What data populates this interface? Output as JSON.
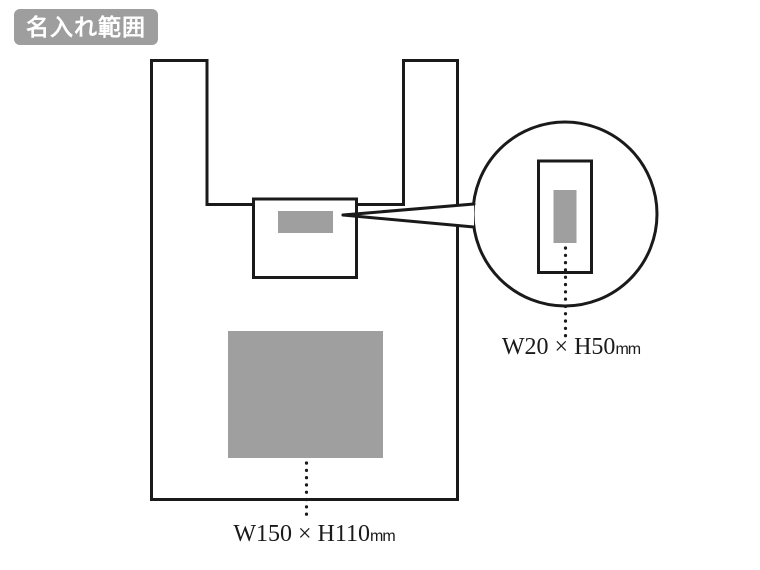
{
  "title_badge": {
    "label": "名入れ範囲"
  },
  "diagram": {
    "main_print_area": {
      "dimension": "W150 × H110",
      "unit": "mm"
    },
    "detail_print_area": {
      "dimension": "W20 × H50",
      "unit": "mm"
    }
  },
  "colors": {
    "badge_background": "#9e9e9e",
    "badge_text": "#ffffff",
    "print_area_fill": "#9f9fa0",
    "outline": "#1a1a1a",
    "background": "#ffffff"
  }
}
